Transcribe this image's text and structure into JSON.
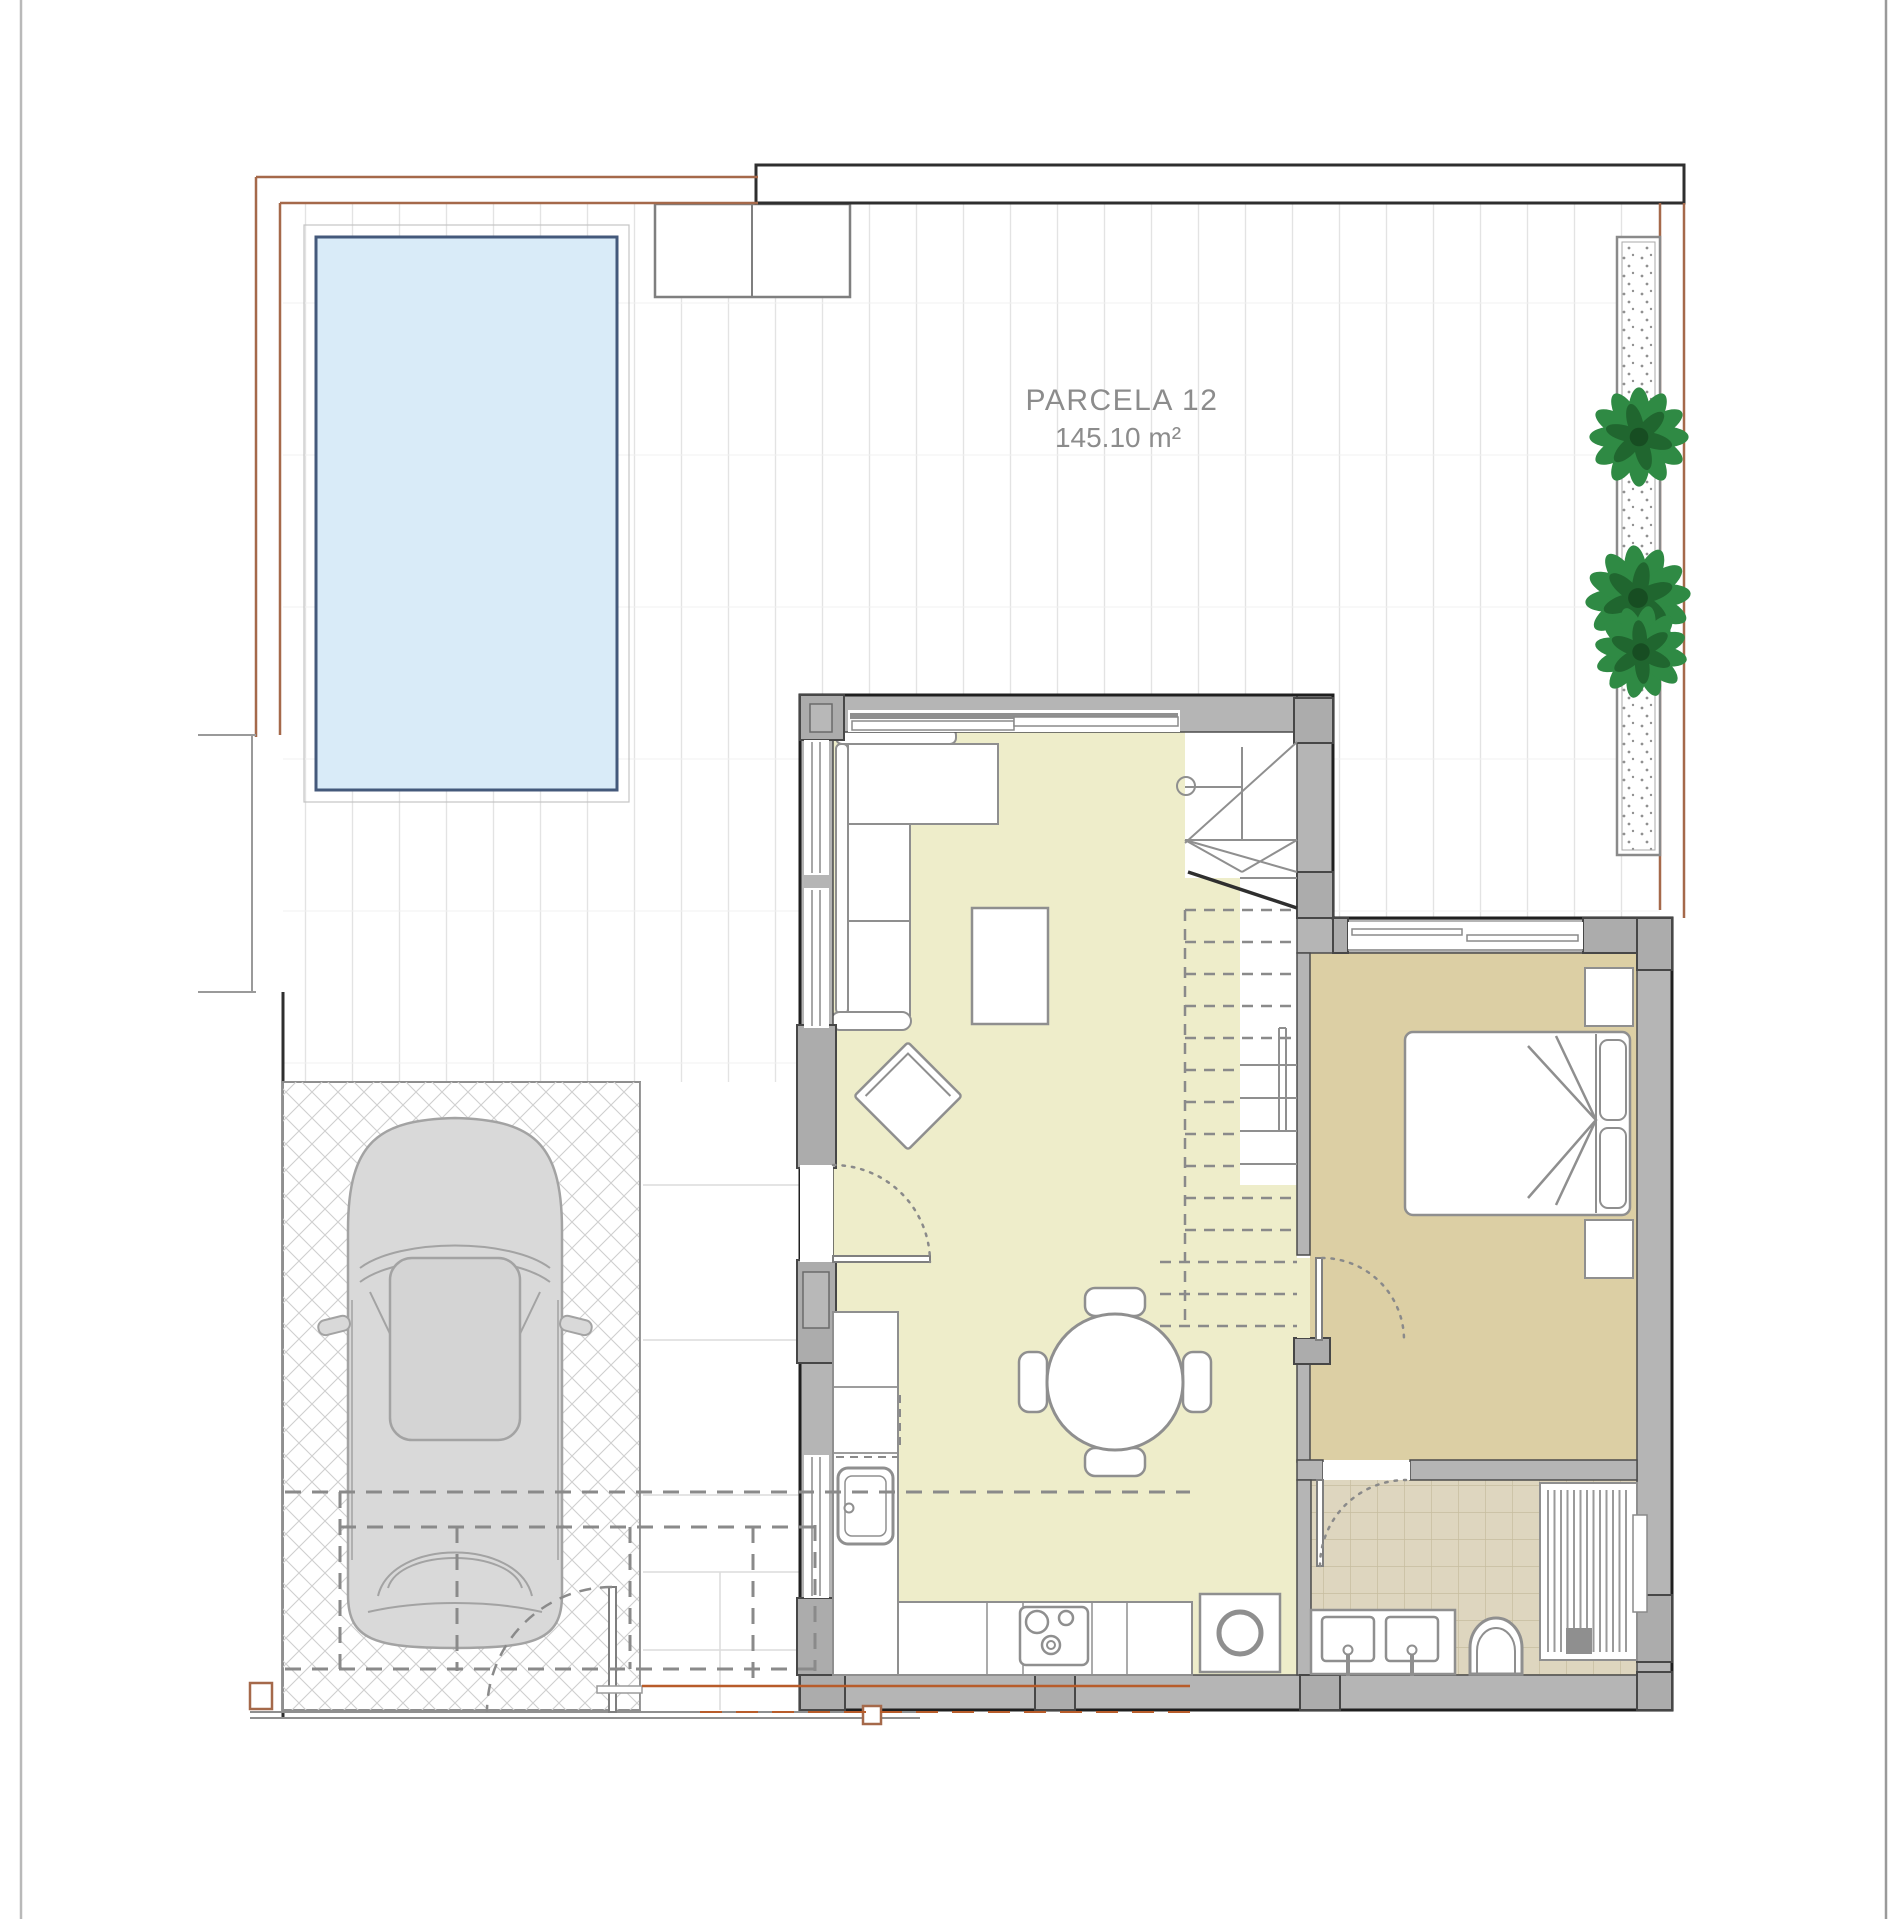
{
  "plan": {
    "parcel_label": "PARCELA 12",
    "parcel_area": "145.10 m²"
  },
  "colors": {
    "pool_fill": "#d9ebf8",
    "pool_border": "#44597b",
    "living_floor": "#eeedca",
    "bedroom_floor": "#dccfa4",
    "bath_tile_line": "#c6bd9f",
    "wall_fill": "#b5b5b5",
    "wall_outline": "#2f2f2f",
    "boundary_brown": "#a5694a",
    "entrance_orange": "#b85c2a",
    "plant_green": "#2f8a44",
    "car_body": "#d9d9d9",
    "annotation_gray": "#8a8a8a",
    "furniture_stroke": "#8f8f8f"
  }
}
